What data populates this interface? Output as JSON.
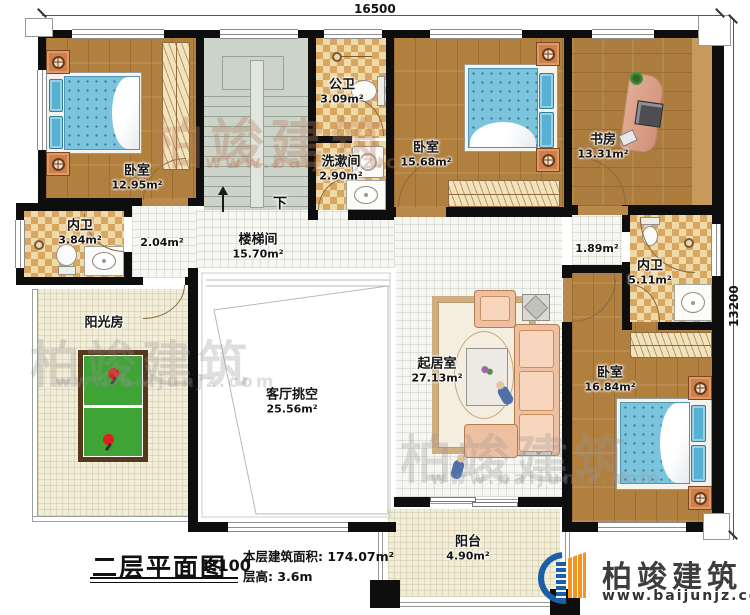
{
  "dims": {
    "top": "16500",
    "right": "13200"
  },
  "rooms": {
    "bedroom_tl": {
      "name": "卧室",
      "area": "12.95m²"
    },
    "stairwell": {
      "name": "楼梯间",
      "area": "15.70m²"
    },
    "down_label": "下",
    "public_bath": {
      "name": "公卫",
      "area": "3.09m²"
    },
    "washroom": {
      "name": "洗漱间",
      "area": "2.90m²"
    },
    "bedroom_tm": {
      "name": "卧室",
      "area": "15.68m²"
    },
    "study": {
      "name": "书房",
      "area": "13.31m²"
    },
    "bath_l": {
      "name": "内卫",
      "area": "3.84m²"
    },
    "bath_r": {
      "name": "内卫",
      "area": "5.11m²"
    },
    "hall_l": {
      "area": "2.04m²"
    },
    "hall_r": {
      "area": "1.89m²"
    },
    "sunroom": {
      "name": "阳光房"
    },
    "void": {
      "name": "客厅挑空",
      "area": "25.56m²"
    },
    "living": {
      "name": "起居室",
      "area": "27.13m²"
    },
    "bedroom_br": {
      "name": "卧室",
      "area": "16.84m²"
    },
    "balcony": {
      "name": "阳台",
      "area": "4.90m²"
    }
  },
  "title": {
    "main": "二层平面图",
    "scale": "1:100",
    "floor_area": "本层建筑面积: 174.07m²",
    "floor_height": "层高: 3.6m"
  },
  "brand": {
    "name": "柏竣建筑",
    "url": "www.baijunjz.com"
  },
  "watermark": {
    "name": "柏竣建筑",
    "url": "www.baijunjz.com"
  },
  "colors": {
    "wall": "#0e0e0e",
    "wood": "#b1803f",
    "checker_light": "#eedaa9",
    "checker_dark": "#d9a660",
    "stair": "#ccd3c8",
    "bed_blue": "#7cc4dd",
    "accent_blue": "#1a5fa8",
    "accent_orange": "#f7941d",
    "pingpong_green": "#3fa436"
  }
}
